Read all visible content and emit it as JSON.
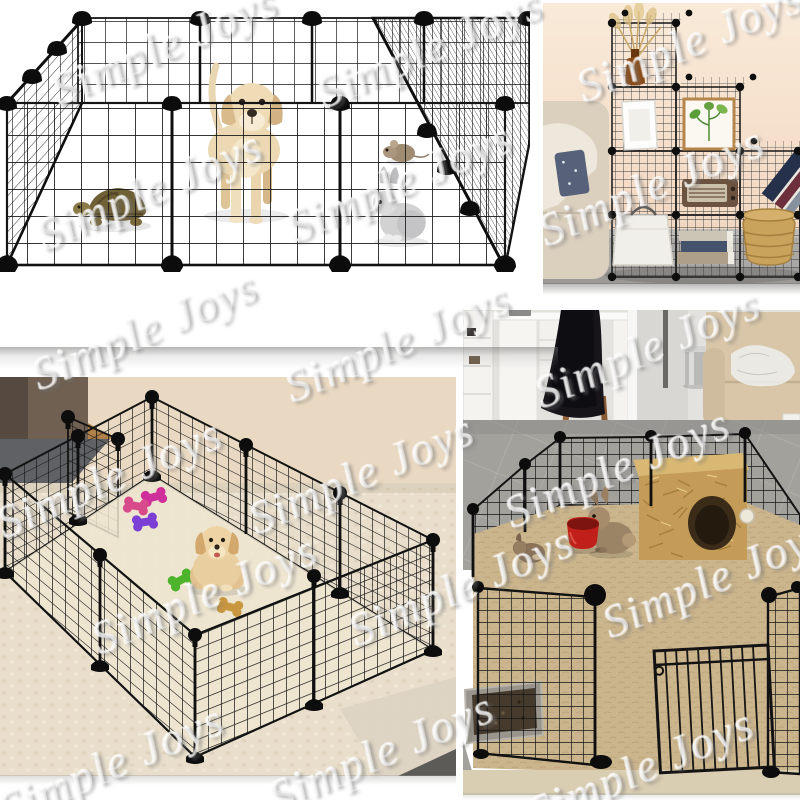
{
  "watermark": {
    "text": "Simple Joys"
  },
  "collage": {
    "background": "#ffffff",
    "panels": [
      {
        "id": "playpen-white",
        "alt": "Black wire pet playpen on white background with labrador puppy, turtle, mouse and rabbit inside"
      },
      {
        "id": "cube-storage",
        "alt": "Wire grid cube storage shelves styled in a living room with vase, frames, radio, books and basket"
      },
      {
        "id": "carpet-playpen",
        "alt": "Wire playpen on cream carpet with golden puppy and colorful bone toys"
      },
      {
        "id": "rabbit-pen",
        "alt": "Wire pen indoors on tile floor with rabbits, straw hideout house, red bowl and litter tray"
      }
    ],
    "colors": {
      "wire_black": "#141414",
      "wall_peach": "#f7e4d0",
      "concrete_gray": "#a9a8a4",
      "carpet_cream": "#e8decb",
      "sofa_beige": "#d9c6a8",
      "hay_tan": "#c49c58",
      "bowl_red": "#c1201a",
      "toy_green": "#4db32a",
      "toy_pink": "#d84b8a",
      "toy_magenta": "#cf2f9a",
      "toy_purple": "#7b3fd6",
      "toy_tan": "#c9973f"
    }
  }
}
